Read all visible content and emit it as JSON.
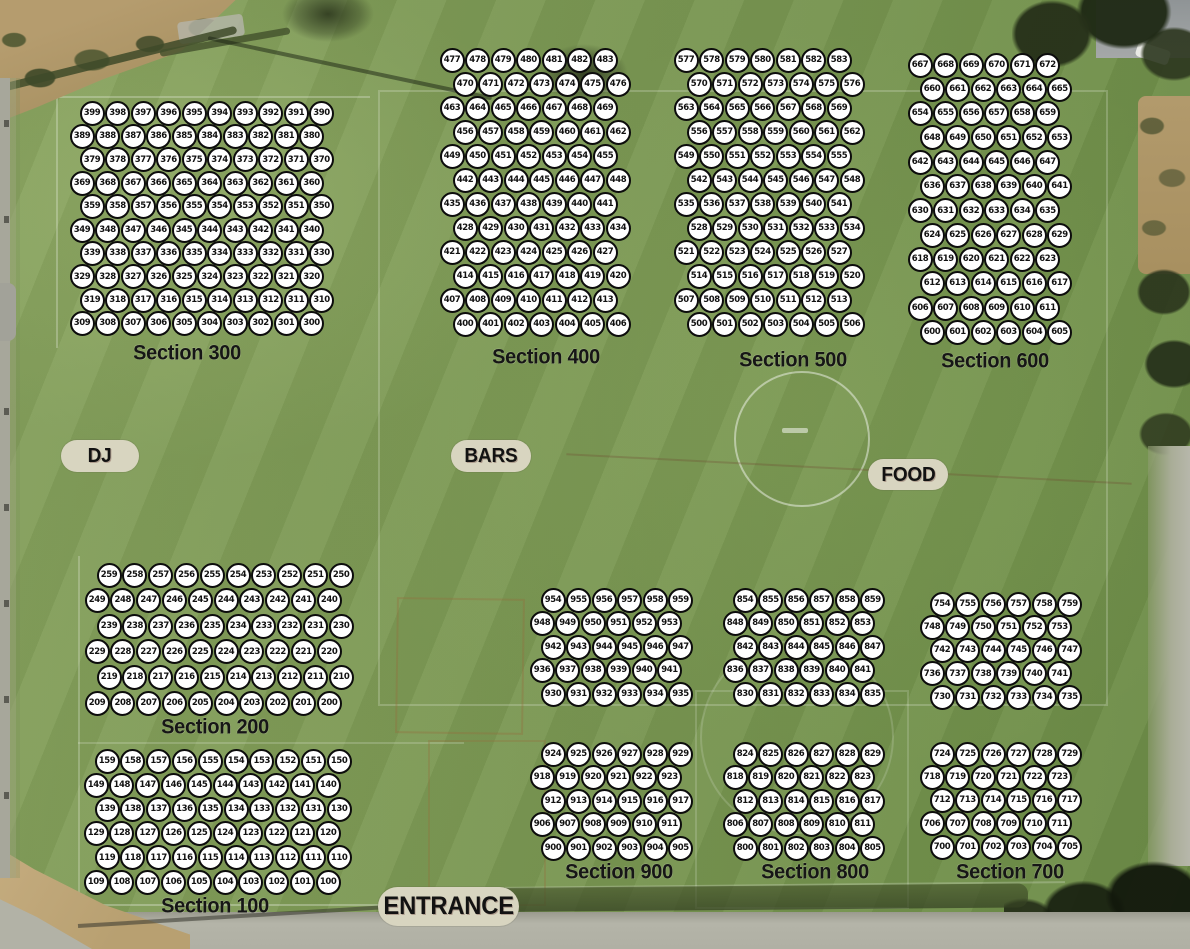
{
  "colors": {
    "field_green": "#7b9754",
    "seat_fill": "#ffffff",
    "seat_border": "#0c0c0c",
    "seat_text": "#111111",
    "label_color": "#161616",
    "pill_bg": "#d8d5c0",
    "pitch_line_white": "rgba(255,255,255,0.45)"
  },
  "areas": {
    "dj": "DJ",
    "bars": "BARS",
    "food": "FOOD",
    "entrance": "ENTRANCE"
  },
  "sections": [
    {
      "id": "300",
      "label": "Section 300",
      "label_x": 187,
      "label_y": 353,
      "x0": 82,
      "y0": 113,
      "col_w": 25.5,
      "row_h": 23.4,
      "offsets": [
        10,
        0,
        10,
        0,
        10,
        0,
        10,
        0,
        10,
        0
      ],
      "rows": [
        [
          399,
          398,
          397,
          396,
          395,
          394,
          393,
          392,
          391,
          390
        ],
        [
          389,
          388,
          387,
          386,
          385,
          384,
          383,
          382,
          381,
          380
        ],
        [
          379,
          378,
          377,
          376,
          375,
          374,
          373,
          372,
          371,
          370
        ],
        [
          369,
          368,
          367,
          366,
          365,
          364,
          363,
          362,
          361,
          360
        ],
        [
          359,
          358,
          357,
          356,
          355,
          354,
          353,
          352,
          351,
          350
        ],
        [
          349,
          348,
          347,
          346,
          345,
          344,
          343,
          342,
          341,
          340
        ],
        [
          339,
          338,
          337,
          336,
          335,
          334,
          333,
          332,
          331,
          330
        ],
        [
          329,
          328,
          327,
          326,
          325,
          324,
          323,
          322,
          321,
          320
        ],
        [
          319,
          318,
          317,
          316,
          315,
          314,
          313,
          312,
          311,
          310
        ],
        [
          309,
          308,
          307,
          306,
          305,
          304,
          303,
          302,
          301,
          300
        ]
      ]
    },
    {
      "id": "400",
      "label": "Section 400",
      "label_x": 546,
      "label_y": 357,
      "x0": 452,
      "y0": 60,
      "col_w": 25.5,
      "row_h": 24,
      "offsets": [
        0,
        13,
        0,
        13,
        0,
        13,
        0,
        13,
        0,
        13,
        0,
        13
      ],
      "rows": [
        [
          477,
          478,
          479,
          480,
          481,
          482,
          483
        ],
        [
          470,
          471,
          472,
          473,
          474,
          475,
          476
        ],
        [
          463,
          464,
          465,
          466,
          467,
          468,
          469
        ],
        [
          456,
          457,
          458,
          459,
          460,
          461,
          462
        ],
        [
          449,
          450,
          451,
          452,
          453,
          454,
          455
        ],
        [
          442,
          443,
          444,
          445,
          446,
          447,
          448
        ],
        [
          435,
          436,
          437,
          438,
          439,
          440,
          441
        ],
        [
          428,
          429,
          430,
          431,
          432,
          433,
          434
        ],
        [
          421,
          422,
          423,
          424,
          425,
          426,
          427
        ],
        [
          414,
          415,
          416,
          417,
          418,
          419,
          420
        ],
        [
          407,
          408,
          409,
          410,
          411,
          412,
          413
        ],
        [
          400,
          401,
          402,
          403,
          404,
          405,
          406
        ]
      ]
    },
    {
      "id": "500",
      "label": "Section 500",
      "label_x": 793,
      "label_y": 360,
      "x0": 686,
      "y0": 60,
      "col_w": 25.5,
      "row_h": 24,
      "offsets": [
        0,
        13,
        0,
        13,
        0,
        13,
        0,
        13,
        0,
        13,
        0,
        13
      ],
      "rows": [
        [
          577,
          578,
          579,
          580,
          581,
          582,
          583
        ],
        [
          570,
          571,
          572,
          573,
          574,
          575,
          576
        ],
        [
          563,
          564,
          565,
          566,
          567,
          568,
          569
        ],
        [
          556,
          557,
          558,
          559,
          560,
          561,
          562
        ],
        [
          549,
          550,
          551,
          552,
          553,
          554,
          555
        ],
        [
          542,
          543,
          544,
          545,
          546,
          547,
          548
        ],
        [
          535,
          536,
          537,
          538,
          539,
          540,
          541
        ],
        [
          528,
          529,
          530,
          531,
          532,
          533,
          534
        ],
        [
          521,
          522,
          523,
          524,
          525,
          526,
          527
        ],
        [
          514,
          515,
          516,
          517,
          518,
          519,
          520
        ],
        [
          507,
          508,
          509,
          510,
          511,
          512,
          513
        ],
        [
          500,
          501,
          502,
          503,
          504,
          505,
          506
        ]
      ]
    },
    {
      "id": "600",
      "label": "Section 600",
      "label_x": 995,
      "label_y": 361,
      "x0": 920,
      "y0": 65,
      "col_w": 25.5,
      "row_h": 24.3,
      "offsets": [
        0,
        12,
        0,
        12,
        0,
        12,
        0,
        12,
        0,
        12,
        0,
        12
      ],
      "rows": [
        [
          667,
          668,
          669,
          670,
          671,
          672
        ],
        [
          660,
          661,
          662,
          663,
          664,
          665
        ],
        [
          654,
          655,
          656,
          657,
          658,
          659
        ],
        [
          648,
          649,
          650,
          651,
          652,
          653
        ],
        [
          642,
          643,
          644,
          645,
          646,
          647
        ],
        [
          636,
          637,
          638,
          639,
          640,
          641
        ],
        [
          630,
          631,
          632,
          633,
          634,
          635
        ],
        [
          624,
          625,
          626,
          627,
          628,
          629
        ],
        [
          618,
          619,
          620,
          621,
          622,
          623
        ],
        [
          612,
          613,
          614,
          615,
          616,
          617
        ],
        [
          606,
          607,
          608,
          609,
          610,
          611
        ],
        [
          600,
          601,
          602,
          603,
          604,
          605
        ]
      ]
    },
    {
      "id": "200",
      "label": "Section 200",
      "label_x": 215,
      "label_y": 727,
      "x0": 97,
      "y0": 575,
      "col_w": 25.8,
      "row_h": 25.6,
      "offsets": [
        12,
        0,
        12,
        0,
        12,
        0
      ],
      "rows": [
        [
          259,
          258,
          257,
          256,
          255,
          254,
          253,
          252,
          251,
          250
        ],
        [
          249,
          248,
          247,
          246,
          245,
          244,
          243,
          242,
          241,
          240
        ],
        [
          239,
          238,
          237,
          236,
          235,
          234,
          233,
          232,
          231,
          230
        ],
        [
          229,
          228,
          227,
          226,
          225,
          224,
          223,
          222,
          221,
          220
        ],
        [
          219,
          218,
          217,
          216,
          215,
          214,
          213,
          212,
          211,
          210
        ],
        [
          209,
          208,
          207,
          206,
          205,
          204,
          203,
          202,
          201,
          200
        ]
      ]
    },
    {
      "id": "100",
      "label": "Section 100",
      "label_x": 215,
      "label_y": 906,
      "x0": 96,
      "y0": 761,
      "col_w": 25.8,
      "row_h": 24.2,
      "offsets": [
        11,
        0,
        11,
        0,
        11,
        0
      ],
      "rows": [
        [
          159,
          158,
          157,
          156,
          155,
          154,
          153,
          152,
          151,
          150
        ],
        [
          149,
          148,
          147,
          146,
          145,
          144,
          143,
          142,
          141,
          140
        ],
        [
          139,
          138,
          137,
          136,
          135,
          134,
          133,
          132,
          131,
          130
        ],
        [
          129,
          128,
          127,
          126,
          125,
          124,
          123,
          122,
          121,
          120
        ],
        [
          119,
          118,
          117,
          116,
          115,
          114,
          113,
          112,
          111,
          110
        ],
        [
          109,
          108,
          107,
          106,
          105,
          104,
          103,
          102,
          101,
          100
        ]
      ]
    },
    {
      "id": "900",
      "label": "Section 900",
      "label_x": 619,
      "label_y": 872,
      "x0": 542,
      "y0": 600,
      "col_w": 25.5,
      "row_h": 23.5,
      "gap_row": 5,
      "gap_extra": 36.5,
      "offsets": [
        11,
        0,
        11,
        0,
        11,
        11,
        0,
        11,
        0,
        11
      ],
      "rows": [
        [
          954,
          955,
          956,
          957,
          958,
          959
        ],
        [
          948,
          949,
          950,
          951,
          952,
          953
        ],
        [
          942,
          943,
          944,
          945,
          946,
          947
        ],
        [
          936,
          937,
          938,
          939,
          940,
          941
        ],
        [
          930,
          931,
          932,
          933,
          934,
          935
        ],
        [
          924,
          925,
          926,
          927,
          928,
          929
        ],
        [
          918,
          919,
          920,
          921,
          922,
          923
        ],
        [
          912,
          913,
          914,
          915,
          916,
          917
        ],
        [
          906,
          907,
          908,
          909,
          910,
          911
        ],
        [
          900,
          901,
          902,
          903,
          904,
          905
        ]
      ]
    },
    {
      "id": "800",
      "label": "Section 800",
      "label_x": 815,
      "label_y": 872,
      "x0": 735,
      "y0": 600,
      "col_w": 25.5,
      "row_h": 23.5,
      "gap_row": 5,
      "gap_extra": 36.5,
      "offsets": [
        10,
        0,
        10,
        0,
        10,
        10,
        0,
        10,
        0,
        10
      ],
      "rows": [
        [
          854,
          855,
          856,
          857,
          858,
          859
        ],
        [
          848,
          849,
          850,
          851,
          852,
          853
        ],
        [
          842,
          843,
          844,
          845,
          846,
          847
        ],
        [
          836,
          837,
          838,
          839,
          840,
          841
        ],
        [
          830,
          831,
          832,
          833,
          834,
          835
        ],
        [
          824,
          825,
          826,
          827,
          828,
          829
        ],
        [
          818,
          819,
          820,
          821,
          822,
          823
        ],
        [
          812,
          813,
          814,
          815,
          816,
          817
        ],
        [
          806,
          807,
          808,
          809,
          810,
          811
        ],
        [
          800,
          801,
          802,
          803,
          804,
          805
        ]
      ]
    },
    {
      "id": "700",
      "label": "Section 700",
      "label_x": 1010,
      "label_y": 872,
      "x0": 932,
      "y0": 604,
      "col_w": 25.5,
      "row_h": 23.3,
      "gap_row": 5,
      "gap_extra": 33.5,
      "offsets": [
        10,
        0,
        10,
        0,
        10,
        10,
        0,
        10,
        0,
        10
      ],
      "rows": [
        [
          754,
          755,
          756,
          757,
          758,
          759
        ],
        [
          748,
          749,
          750,
          751,
          752,
          753
        ],
        [
          742,
          743,
          744,
          745,
          746,
          747
        ],
        [
          736,
          737,
          738,
          739,
          740,
          741
        ],
        [
          730,
          731,
          732,
          733,
          734,
          735
        ],
        [
          724,
          725,
          726,
          727,
          728,
          729
        ],
        [
          718,
          719,
          720,
          721,
          722,
          723
        ],
        [
          712,
          713,
          714,
          715,
          716,
          717
        ],
        [
          706,
          707,
          708,
          709,
          710,
          711
        ],
        [
          700,
          701,
          702,
          703,
          704,
          705
        ]
      ]
    }
  ]
}
